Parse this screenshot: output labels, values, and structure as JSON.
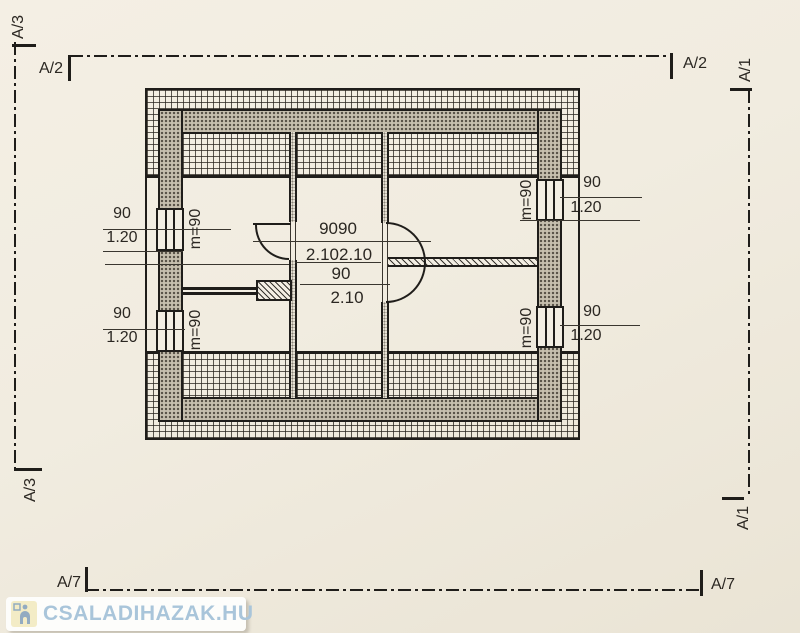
{
  "section_markers": {
    "a1": "A/1",
    "a2": "A/2",
    "a3": "A/3",
    "a7": "A/7"
  },
  "floor_plan": {
    "windows": [
      {
        "position": "left-top",
        "width": "90",
        "height": "1.20",
        "parapet": "m=90"
      },
      {
        "position": "left-bottom",
        "width": "90",
        "height": "1.20",
        "parapet": "m=90"
      },
      {
        "position": "right-top",
        "width": "90",
        "height": "1.20",
        "parapet": "m=90"
      },
      {
        "position": "right-bottom",
        "width": "90",
        "height": "1.20",
        "parapet": "m=90"
      }
    ],
    "doors": {
      "double_widths": "9090",
      "double_heights": "2.102.10",
      "single_width": "90",
      "single_height": "2.10"
    }
  },
  "watermark": {
    "text": "CSALADIHAZAK.HU"
  },
  "colors": {
    "line": "#1f1d1a",
    "paper": "#f1ece0",
    "wall_fill": "#c6bfae",
    "watermark_text": "#a9c5da",
    "watermark_icon_bg": "#f3ecc6",
    "watermark_icon": "#92abc1"
  }
}
